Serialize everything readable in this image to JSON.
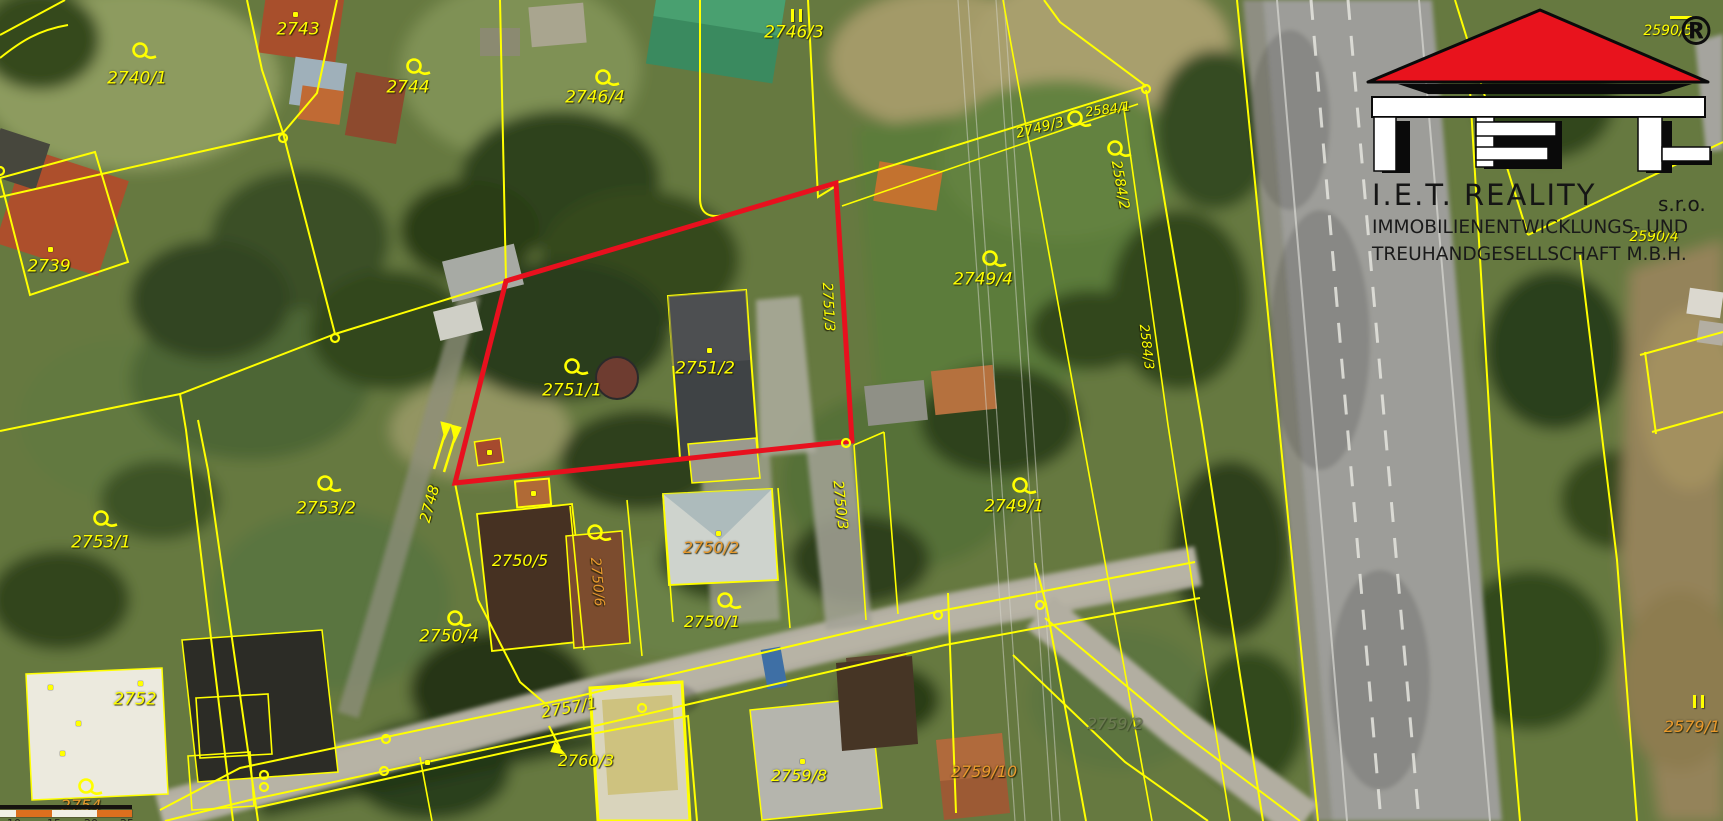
{
  "brand": {
    "line1": "I.E.T. REALITY",
    "suffix": "s.r.o.",
    "line2": "IMMOBILIENENTWICKLUNGS- UND",
    "line3": "TREUHANDGESELLSCHAFT M.B.H.",
    "registered": "®"
  },
  "map": {
    "colors": {
      "boundary": "#ffff00",
      "highlight_outline": "#e8101e",
      "label_yellow": "#ffff00",
      "label_orange": "#e8992c",
      "label_dim": "#6d7a52"
    },
    "highlighted_parcels": [
      "2751/1",
      "2751/2"
    ],
    "labels": [
      {
        "text": "2740/1",
        "x": 137,
        "y": 79,
        "rot": 0,
        "color": "yellow",
        "size": 17
      },
      {
        "text": "2743",
        "x": 298,
        "y": 30,
        "rot": 0,
        "color": "yellow",
        "size": 17
      },
      {
        "text": "2744",
        "x": 408,
        "y": 88,
        "rot": 0,
        "color": "yellow",
        "size": 17
      },
      {
        "text": "2746/4",
        "x": 595,
        "y": 98,
        "rot": 0,
        "color": "yellow",
        "size": 17
      },
      {
        "text": "2746/3",
        "x": 794,
        "y": 33,
        "rot": 0,
        "color": "yellow",
        "size": 17
      },
      {
        "text": "2739",
        "x": 49,
        "y": 267,
        "rot": 0,
        "color": "yellow",
        "size": 17
      },
      {
        "text": "2584/1",
        "x": 1108,
        "y": 110,
        "rot": -8,
        "color": "yellow",
        "size": 13
      },
      {
        "text": "2749/3",
        "x": 1040,
        "y": 128,
        "rot": -14,
        "color": "yellow",
        "size": 14
      },
      {
        "text": "2584/2",
        "x": 1120,
        "y": 185,
        "rot": 80,
        "color": "yellow",
        "size": 14
      },
      {
        "text": "2749/4",
        "x": 983,
        "y": 280,
        "rot": 0,
        "color": "yellow",
        "size": 17
      },
      {
        "text": "2584/3",
        "x": 1146,
        "y": 347,
        "rot": 83,
        "color": "yellow",
        "size": 13
      },
      {
        "text": "2751/1",
        "x": 572,
        "y": 391,
        "rot": 0,
        "color": "yellow",
        "size": 17
      },
      {
        "text": "2751/2",
        "x": 705,
        "y": 369,
        "rot": 0,
        "color": "yellow",
        "size": 17
      },
      {
        "text": "2751/3",
        "x": 828,
        "y": 307,
        "rot": 87,
        "color": "yellow",
        "size": 14
      },
      {
        "text": "2748",
        "x": 430,
        "y": 504,
        "rot": -75,
        "color": "yellow",
        "size": 15
      },
      {
        "text": "2750/3",
        "x": 840,
        "y": 505,
        "rot": 84,
        "color": "yellow",
        "size": 14
      },
      {
        "text": "2749/1",
        "x": 1014,
        "y": 507,
        "rot": 0,
        "color": "yellow",
        "size": 17
      },
      {
        "text": "2753/2",
        "x": 326,
        "y": 509,
        "rot": 0,
        "color": "yellow",
        "size": 17
      },
      {
        "text": "2753/1",
        "x": 101,
        "y": 543,
        "rot": 0,
        "color": "yellow",
        "size": 17
      },
      {
        "text": "2750/4",
        "x": 449,
        "y": 637,
        "rot": 0,
        "color": "yellow",
        "size": 17
      },
      {
        "text": "2750/5",
        "x": 520,
        "y": 561,
        "rot": 0,
        "color": "yellow",
        "size": 16
      },
      {
        "text": "2750/6",
        "x": 597,
        "y": 582,
        "rot": 85,
        "color": "orange",
        "size": 14
      },
      {
        "text": "2750/2",
        "x": 711,
        "y": 548,
        "rot": 0,
        "color": "orange",
        "size": 16
      },
      {
        "text": "2750/1",
        "x": 712,
        "y": 622,
        "rot": 0,
        "color": "yellow",
        "size": 16
      },
      {
        "text": "2752",
        "x": 135,
        "y": 700,
        "rot": 0,
        "color": "yellow",
        "size": 17
      },
      {
        "text": "2757/1",
        "x": 569,
        "y": 708,
        "rot": -10,
        "color": "yellow",
        "size": 16
      },
      {
        "text": "2760/3",
        "x": 586,
        "y": 761,
        "rot": 0,
        "color": "yellow",
        "size": 16
      },
      {
        "text": "2759/8",
        "x": 799,
        "y": 776,
        "rot": 0,
        "color": "yellow",
        "size": 16
      },
      {
        "text": "2759/10",
        "x": 984,
        "y": 772,
        "rot": 0,
        "color": "orange",
        "size": 16
      },
      {
        "text": "2759/2",
        "x": 1115,
        "y": 724,
        "rot": 0,
        "color": "dim",
        "size": 16
      },
      {
        "text": "2579/1",
        "x": 1692,
        "y": 727,
        "rot": 0,
        "color": "orange",
        "size": 16
      },
      {
        "text": "2754",
        "x": 81,
        "y": 806,
        "rot": 0,
        "color": "orange",
        "size": 16
      },
      {
        "text": "2590/5",
        "x": 1668,
        "y": 31,
        "rot": 0,
        "color": "yellow",
        "size": 14
      },
      {
        "text": "2590/4",
        "x": 1654,
        "y": 237,
        "rot": 0,
        "color": "yellow",
        "size": 14
      }
    ],
    "markers": [
      {
        "x": 140,
        "y": 50
      },
      {
        "x": 414,
        "y": 66
      },
      {
        "x": 603,
        "y": 77
      },
      {
        "x": 990,
        "y": 258
      },
      {
        "x": 1115,
        "y": 148
      },
      {
        "x": 1075,
        "y": 118
      },
      {
        "x": 572,
        "y": 366
      },
      {
        "x": 1020,
        "y": 485
      },
      {
        "x": 725,
        "y": 600
      },
      {
        "x": 595,
        "y": 532
      },
      {
        "x": 455,
        "y": 618
      },
      {
        "x": 325,
        "y": 483
      },
      {
        "x": 101,
        "y": 518
      },
      {
        "x": 86,
        "y": 786
      }
    ],
    "nodes": [
      {
        "x": 283,
        "y": 135
      },
      {
        "x": 335,
        "y": 335
      },
      {
        "x": 1146,
        "y": 86
      },
      {
        "x": 642,
        "y": 705
      },
      {
        "x": 386,
        "y": 736
      },
      {
        "x": 384,
        "y": 768
      },
      {
        "x": 938,
        "y": 612
      },
      {
        "x": 1040,
        "y": 602
      },
      {
        "x": 846,
        "y": 440
      },
      {
        "x": 264,
        "y": 772
      },
      {
        "x": 264,
        "y": 784
      },
      {
        "x": 0,
        "y": 168
      }
    ],
    "dots": [
      {
        "x": 295,
        "y": 14
      },
      {
        "x": 50,
        "y": 249
      },
      {
        "x": 709,
        "y": 350
      },
      {
        "x": 718,
        "y": 533
      },
      {
        "x": 533,
        "y": 493
      },
      {
        "x": 802,
        "y": 761
      },
      {
        "x": 140,
        "y": 683
      },
      {
        "x": 78,
        "y": 723
      },
      {
        "x": 62,
        "y": 753
      },
      {
        "x": 50,
        "y": 687
      },
      {
        "x": 427,
        "y": 762
      },
      {
        "x": 489,
        "y": 452
      }
    ],
    "symbols": [
      {
        "type": "double-bar",
        "x": 798,
        "y": 14
      },
      {
        "type": "double-bar",
        "x": 1700,
        "y": 700
      },
      {
        "type": "dash",
        "x": 1681,
        "y": 16
      }
    ]
  },
  "scale_bar": {
    "ticks": [
      "10",
      "15",
      "20",
      "25"
    ],
    "tick_x": [
      7,
      47,
      84,
      120
    ],
    "segments": [
      {
        "w": 16,
        "c": "#f2f0e6"
      },
      {
        "w": 36,
        "c": "#dd6f1e"
      },
      {
        "w": 45,
        "c": "#f2f0e6"
      },
      {
        "w": 35,
        "c": "#dd6f1e"
      }
    ]
  }
}
